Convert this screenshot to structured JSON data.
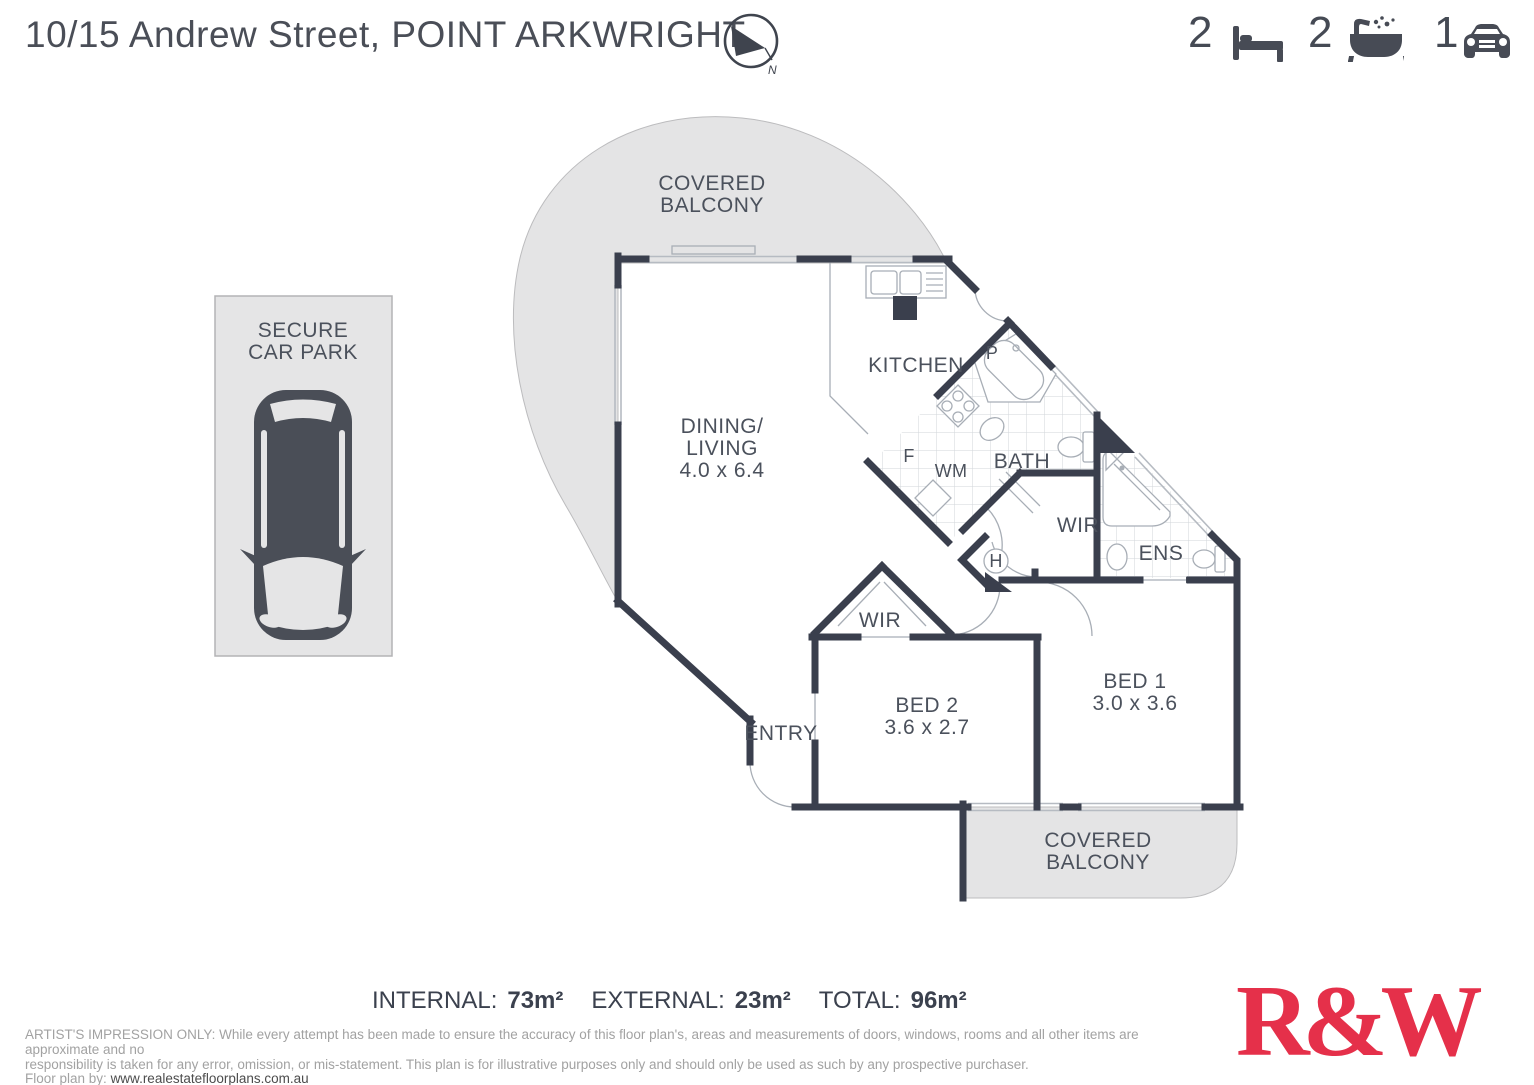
{
  "header": {
    "title": "10/15 Andrew Street, POINT ARKWRIGHT",
    "compass_label": "N",
    "stats": {
      "beds": "2",
      "baths": "2",
      "cars": "1"
    }
  },
  "plan": {
    "balcony_top": [
      "COVERED",
      "BALCONY"
    ],
    "carpark": [
      "SECURE",
      "CAR PARK"
    ],
    "dining": {
      "line1": "DINING/",
      "line2": "LIVING",
      "dims": "4.0 x 6.4"
    },
    "kitchen": "KITCHEN",
    "pantry": "P",
    "fridge": "F",
    "washing_machine": "WM",
    "bath": "BATH",
    "hot_water": "H",
    "wir_ens": "WIR",
    "ens": "ENS",
    "wir_bed2": "WIR",
    "bed2": {
      "name": "BED 2",
      "dims": "3.6 x 2.7"
    },
    "bed1": {
      "name": "BED 1",
      "dims": "3.0 x 3.6"
    },
    "entry": "ENTRY",
    "balcony_bottom": [
      "COVERED",
      "BALCONY"
    ]
  },
  "footer": {
    "internal_label": "INTERNAL:",
    "internal_value": "73m²",
    "external_label": "EXTERNAL:",
    "external_value": "23m²",
    "total_label": "TOTAL:",
    "total_value": "96m²",
    "disclaimer_line1": "ARTIST'S IMPRESSION ONLY: While every attempt has been made to ensure the accuracy of this floor plan's, areas and measurements of doors, windows, rooms and all other items are approximate and no",
    "disclaimer_line2": "responsibility is taken for any error, omission, or mis-statement. This plan is for illustrative purposes only and should only be used as such by any prospective purchaser.",
    "floorplan_by_label": "Floor plan by:",
    "floorplan_by_url": "www.realestatefloorplans.com.au",
    "logo": "R&W"
  },
  "colors": {
    "wall": "#3a3f4d",
    "balcony_fill": "#e4e4e5",
    "logo_red": "#e5304a",
    "icon_dark": "#474b55"
  }
}
